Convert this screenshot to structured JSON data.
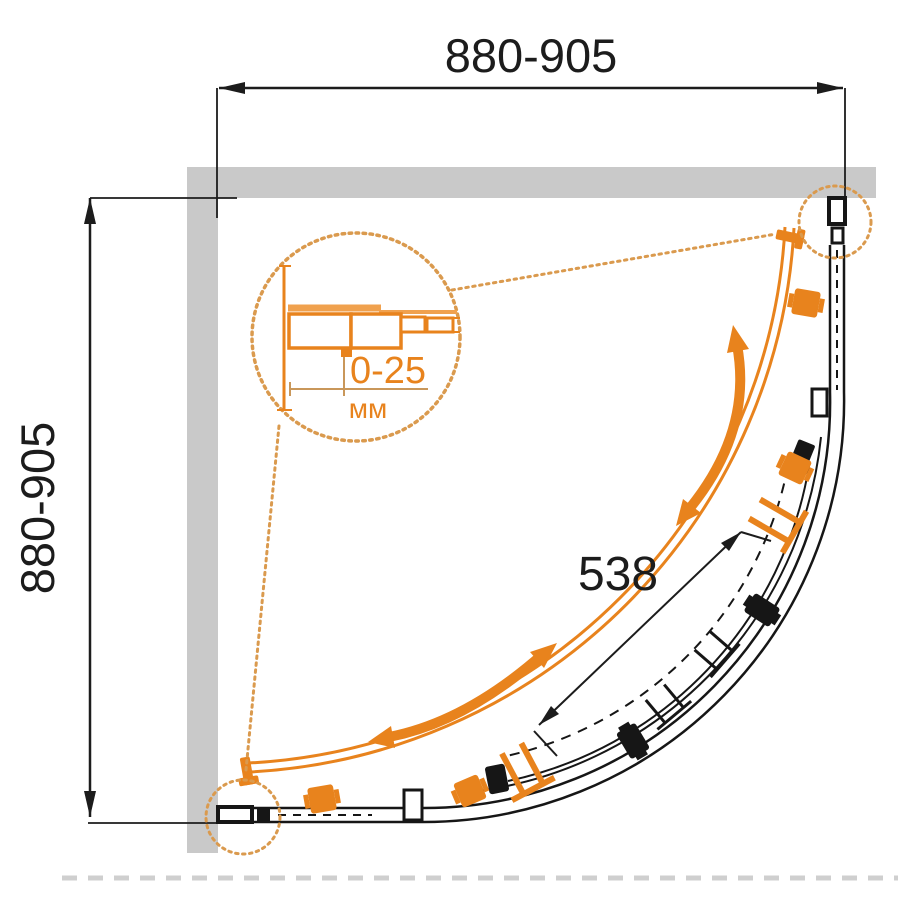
{
  "figure": {
    "type": "technical-drawing",
    "subject": "quadrant corner shower enclosure - plan view installation drawing",
    "dims": {
      "top_width": "880-905",
      "side_depth": "880-905",
      "door_opening": "538"
    },
    "detail": {
      "adjustment": "0-25",
      "unit": "мм"
    },
    "colors": {
      "accent_orange": "#e8831d",
      "accent_orange_light": "#f0a14e",
      "leader_orange": "#da9a4e",
      "wall_gray": "#c9c9c9",
      "line_black": "#1c1c1c"
    }
  }
}
